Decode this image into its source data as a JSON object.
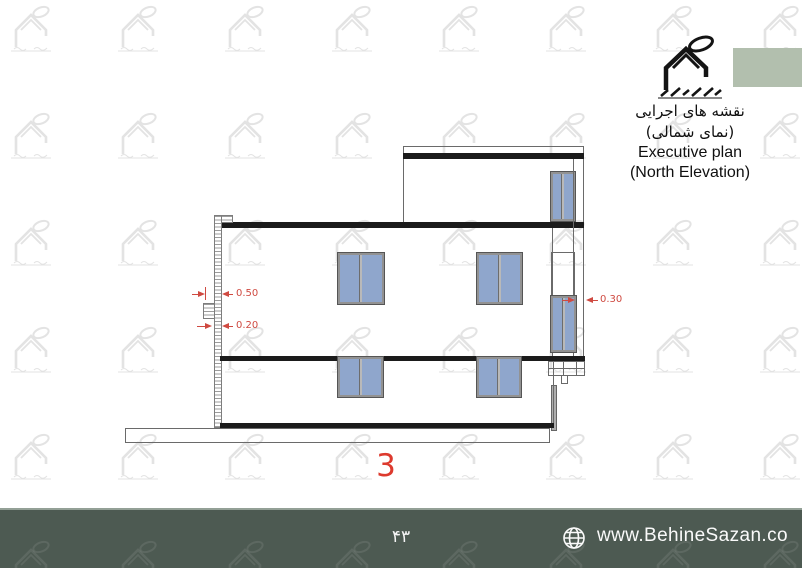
{
  "header": {
    "logo": "behinesazan-house-logo",
    "title_fa_line1": "نقشه های اجرایی",
    "title_fa_line2": "(نمای شمالی)",
    "title_en_line1": "Executive plan",
    "title_en_line2": "(North Elevation)"
  },
  "drawing": {
    "type": "architectural-elevation",
    "sheet_number": "3",
    "dimensions": {
      "left_upper": "0.50",
      "left_lower": "0.20",
      "right": "0.30"
    }
  },
  "footer": {
    "page_number_fa": "۴۳",
    "icon": "globe-icon",
    "website": "www.BehineSazan.co"
  },
  "colors": {
    "window_blue": "#8fa6cc",
    "dimension_red": "#cf4a41",
    "sheet_number_red": "#dd3a2e",
    "footer_background": "#4d5a52",
    "logo_green_block": "#b2bfae",
    "watermark_gray": "#e3e3e3",
    "line_black": "#1b1b1b"
  }
}
